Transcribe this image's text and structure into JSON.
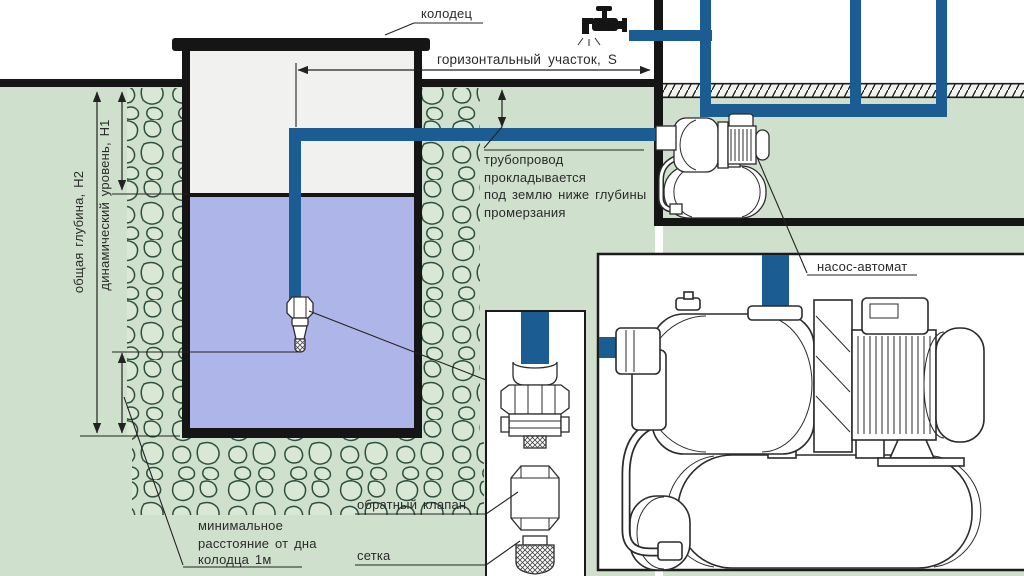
{
  "diagram": {
    "labels": {
      "well": "колодец",
      "horizontal_section": "горизонтальный участок, S",
      "total_depth": "общая глубина, Н2",
      "dynamic_level": "динамический уровень, Н1",
      "pipeline_note_line1": "трубопровод",
      "pipeline_note_line2": "прокладывается",
      "pipeline_note_line3": "под землю ниже глубины",
      "pipeline_note_line4": "промерзания",
      "min_distance_line1": "минимальное",
      "min_distance_line2": "расстояние от дна",
      "min_distance_line3": "колодца 1м",
      "check_valve": "обратный клапан",
      "strainer": "сетка",
      "pump": "насос-автомат"
    },
    "colors": {
      "pipe": "#1b5c92",
      "water": "#aeb5e8",
      "ground": "#cfe1cc",
      "stone_fill": "#d9e8d4",
      "stone_outline": "#2f5040",
      "well_interior": "#f1f1f0",
      "line": "#222222",
      "structure": "#151515"
    }
  }
}
